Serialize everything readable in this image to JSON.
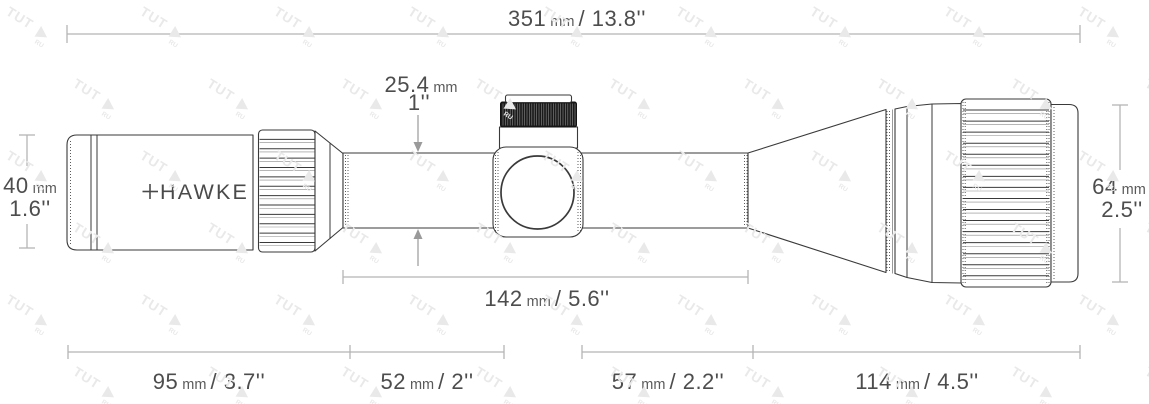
{
  "brand": {
    "logo_text": "HAWKE"
  },
  "watermark": {
    "text": "TUT",
    "sub": "RU"
  },
  "dimensions": {
    "total_length": {
      "value": "351",
      "unit": " mm ",
      "imperial": "/ 13.8''"
    },
    "mount_length": {
      "value": "142",
      "unit": " mm ",
      "imperial": "/ 5.6''"
    },
    "eyepiece_length": {
      "value": "95",
      "unit": " mm ",
      "imperial": "/ 3.7''"
    },
    "tube_rear_length": {
      "value": "52",
      "unit": " mm ",
      "imperial": "/ 2''"
    },
    "tube_front_length": {
      "value": "57",
      "unit": " mm ",
      "imperial": "/ 2.2''"
    },
    "objective_length": {
      "value": "114",
      "unit": " mm ",
      "imperial": "/ 4.5''"
    },
    "tube_diameter": {
      "value": "25.4",
      "unit": " mm",
      "imperial": "1''"
    },
    "eyepiece_diameter": {
      "value": "40",
      "unit": " mm",
      "imperial": "1.6''"
    },
    "objective_diameter": {
      "value": "64",
      "unit": " mm",
      "imperial": "2.5''"
    }
  },
  "colors": {
    "outline": "#3a3a3a",
    "dimension_line": "#b5b5b5",
    "label_text": "#4d4d4d",
    "arrow": "#9a9a9a",
    "turret_cap": "#1a1a1a",
    "watermark": "#e9e9e9"
  }
}
